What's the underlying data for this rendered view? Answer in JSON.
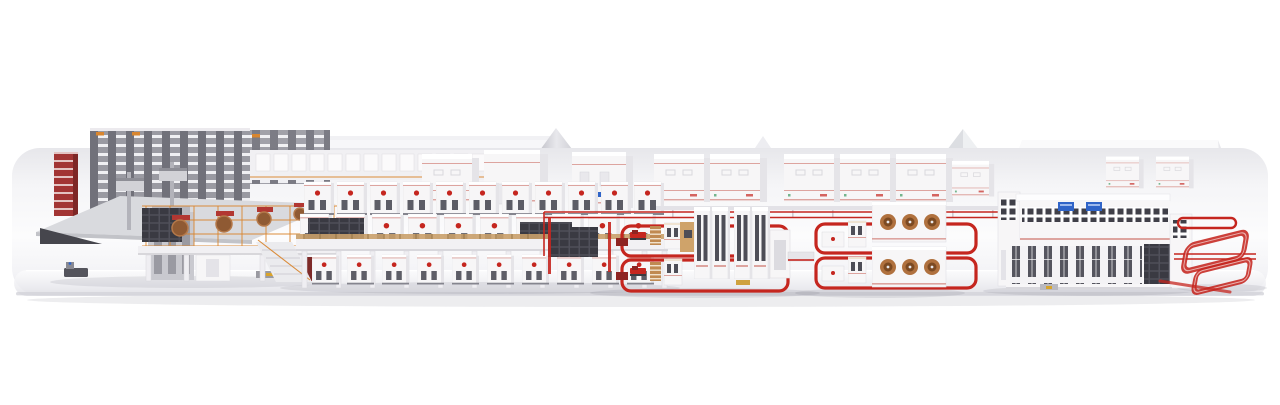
{
  "colors": {
    "bg": "#ffffff",
    "platform_top": "#fafafb",
    "platform_back": "#e8e8ec",
    "platform_face": "#e9e9ee",
    "platform_edge": "#d3d3d9",
    "machine_white": "#f7f6f7",
    "machine_shade": "#e5e4e8",
    "panel_dark": "#3d3d45",
    "rack_gray": "#9a9aa2",
    "rack_dark": "#71717a",
    "accent_red": "#c5261f",
    "trim_red": "#dda49f",
    "dark_red": "#8e2422",
    "orange": "#d9862f",
    "wood": "#c08a52",
    "roll_brown": "#8f5a33",
    "copper": "#b0713e",
    "screen_blue": "#2f64c8",
    "canopy": "#d9dade",
    "agv_dark": "#54545c",
    "shadow": "rgba(70,70,90,0.10)"
  }
}
